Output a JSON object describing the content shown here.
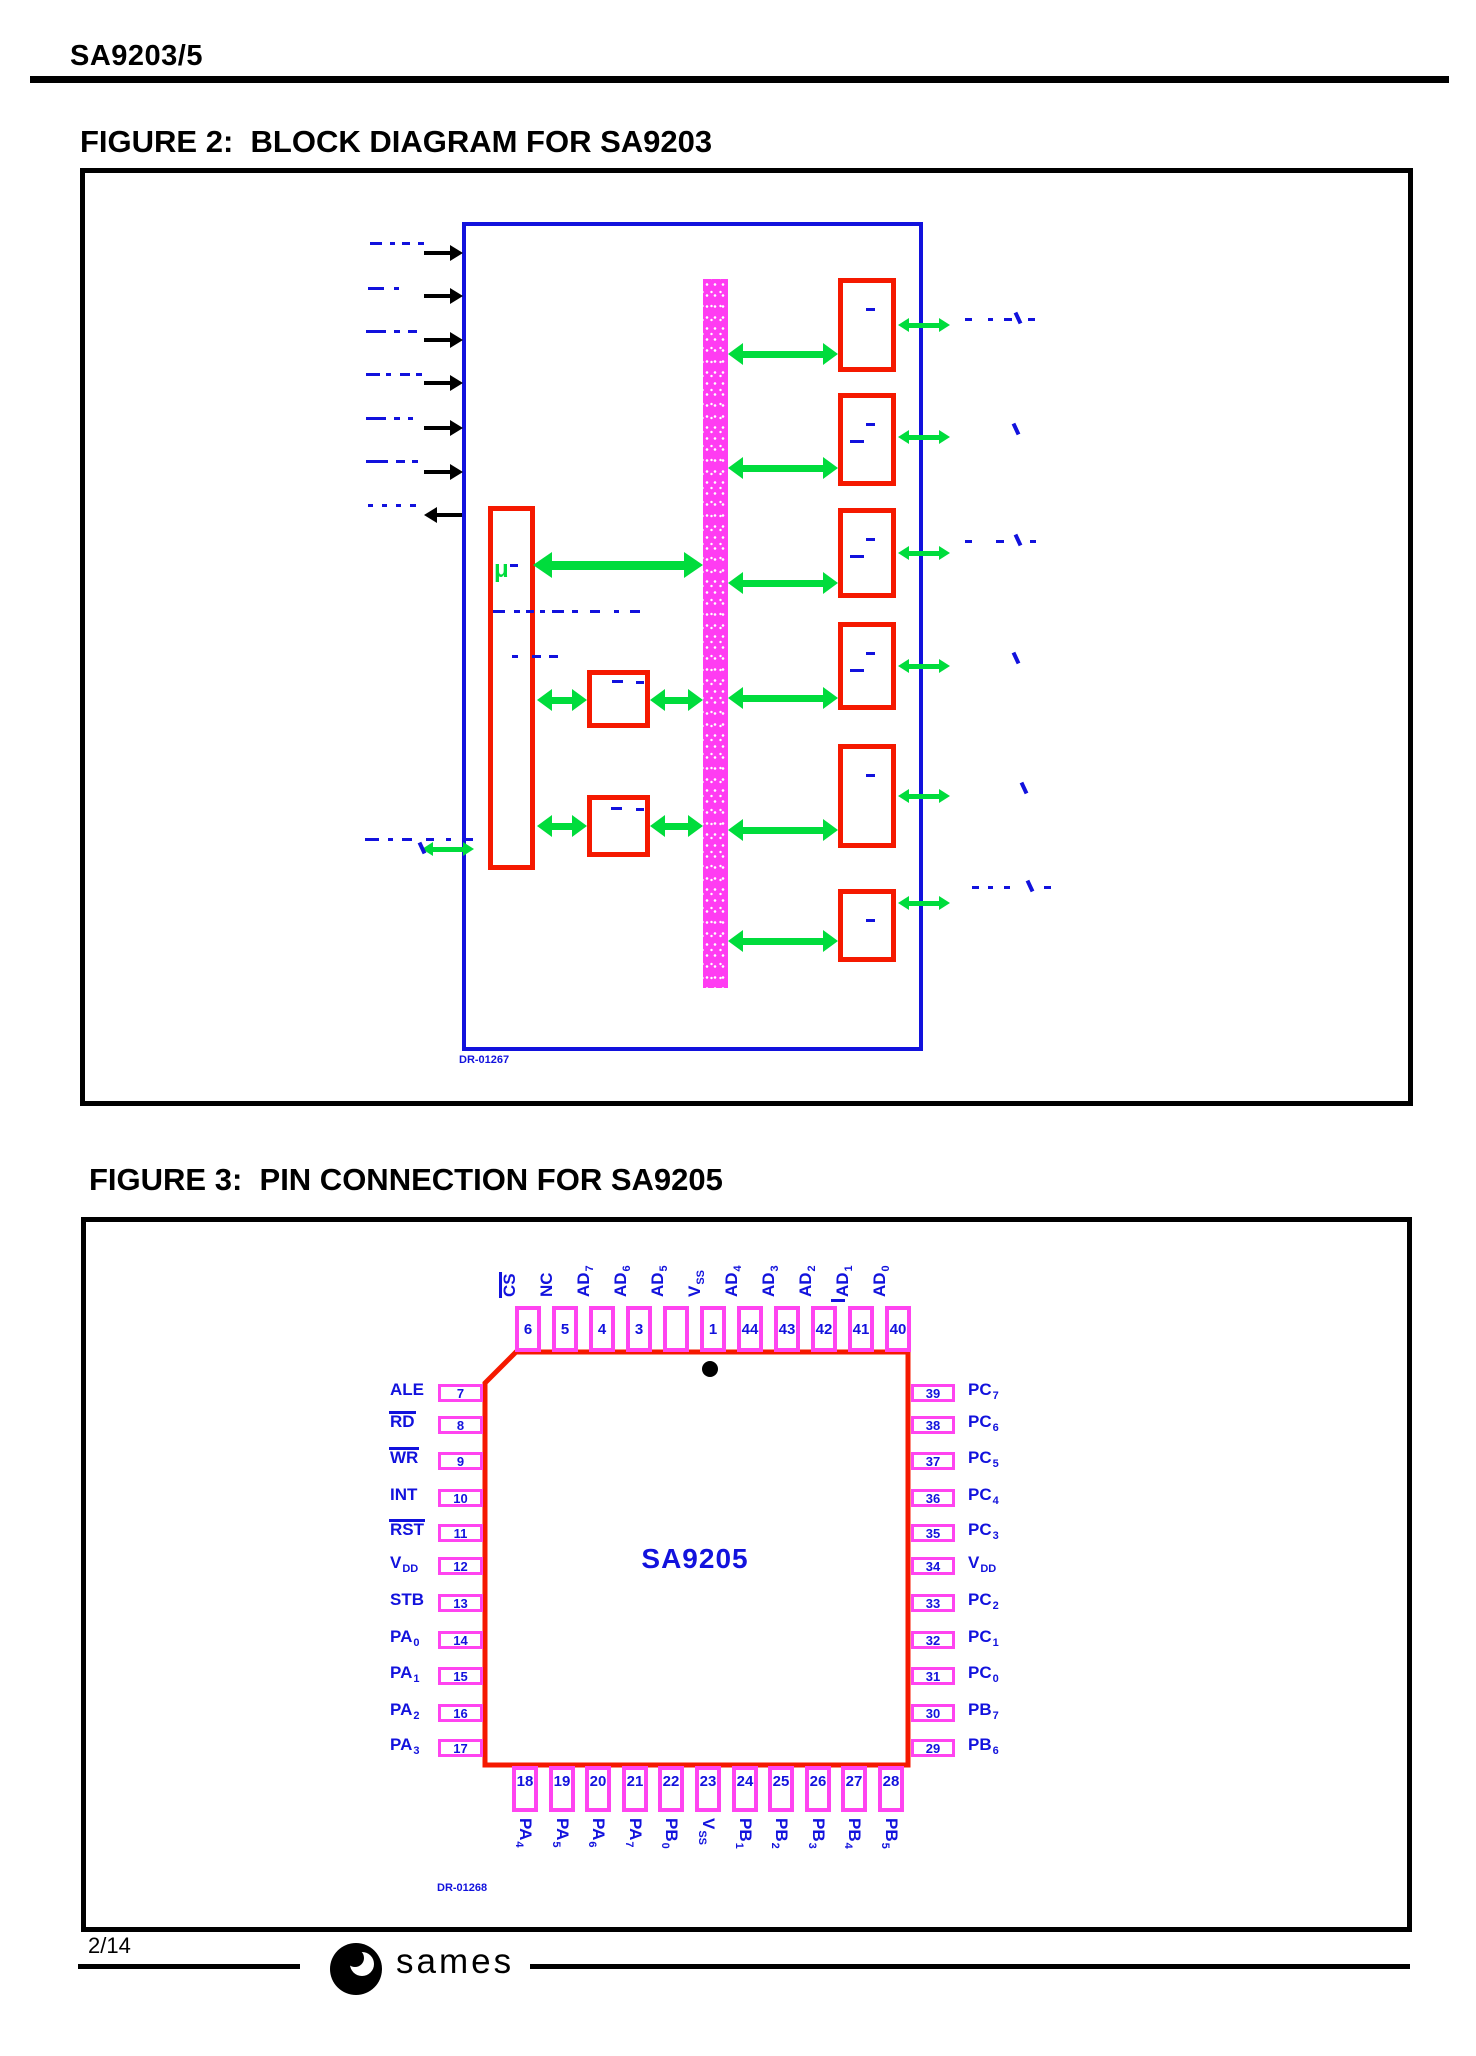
{
  "colors": {
    "line_blue": "#1212dd",
    "box_red": "#f51900",
    "pin_magenta": "#ff44f0",
    "bus_magenta": "#ff3cf2",
    "arrow_green": "#00dc3c",
    "ink_black": "#000000"
  },
  "header": {
    "part_number": "SA9203/5"
  },
  "figure2": {
    "title": "FIGURE 2:  BLOCK DIAGRAM FOR SA9203",
    "micro_label": "μ",
    "drawing_ref": "DR-01267"
  },
  "figure3": {
    "title": "FIGURE 3:  PIN CONNECTION FOR SA9205",
    "chip_name": "SA9205",
    "drawing_ref": "DR-01268",
    "top_pins": [
      {
        "num": "6",
        "base": "CS",
        "overline": true
      },
      {
        "num": "5",
        "base": "NC"
      },
      {
        "num": "4",
        "base": "AD",
        "sub": "7"
      },
      {
        "num": "3",
        "base": "AD",
        "sub": "6"
      },
      {
        "num": "",
        "base": "AD",
        "sub": "5"
      },
      {
        "num": "1",
        "base": "V",
        "sub": "SS"
      },
      {
        "num": "44",
        "base": "AD",
        "sub": "4"
      },
      {
        "num": "43",
        "base": "AD",
        "sub": "3"
      },
      {
        "num": "42",
        "base": "AD",
        "sub": "2"
      },
      {
        "num": "41",
        "base": "AD",
        "sub": "1"
      },
      {
        "num": "40",
        "base": "AD",
        "sub": "0"
      }
    ],
    "left_pins": [
      {
        "num": "7",
        "base": "ALE"
      },
      {
        "num": "8",
        "base": "RD",
        "overline": true
      },
      {
        "num": "9",
        "base": "WR",
        "overline": true
      },
      {
        "num": "10",
        "base": "INT"
      },
      {
        "num": "11",
        "base": "RST",
        "overline": true
      },
      {
        "num": "12",
        "base": "V",
        "sub": "DD"
      },
      {
        "num": "13",
        "base": "STB"
      },
      {
        "num": "14",
        "base": "PA",
        "sub": "0"
      },
      {
        "num": "15",
        "base": "PA",
        "sub": "1"
      },
      {
        "num": "16",
        "base": "PA",
        "sub": "2"
      },
      {
        "num": "17",
        "base": "PA",
        "sub": "3"
      }
    ],
    "right_pins": [
      {
        "num": "39",
        "base": "PC",
        "sub": "7"
      },
      {
        "num": "38",
        "base": "PC",
        "sub": "6"
      },
      {
        "num": "37",
        "base": "PC",
        "sub": "5"
      },
      {
        "num": "36",
        "base": "PC",
        "sub": "4"
      },
      {
        "num": "35",
        "base": "PC",
        "sub": "3"
      },
      {
        "num": "34",
        "base": "V",
        "sub": "DD"
      },
      {
        "num": "33",
        "base": "PC",
        "sub": "2"
      },
      {
        "num": "32",
        "base": "PC",
        "sub": "1"
      },
      {
        "num": "31",
        "base": "PC",
        "sub": "0"
      },
      {
        "num": "30",
        "base": "PB",
        "sub": "7"
      },
      {
        "num": "29",
        "base": "PB",
        "sub": "6"
      }
    ],
    "bottom_pins": [
      {
        "num": "18",
        "base": "PA",
        "sub": "4"
      },
      {
        "num": "19",
        "base": "PA",
        "sub": "5"
      },
      {
        "num": "20",
        "base": "PA",
        "sub": "6"
      },
      {
        "num": "21",
        "base": "PA",
        "sub": "7"
      },
      {
        "num": "22",
        "base": "PB",
        "sub": "0"
      },
      {
        "num": "23",
        "base": "V",
        "sub": "SS"
      },
      {
        "num": "24",
        "base": "PB",
        "sub": "1"
      },
      {
        "num": "25",
        "base": "PB",
        "sub": "2"
      },
      {
        "num": "26",
        "base": "PB",
        "sub": "3"
      },
      {
        "num": "27",
        "base": "PB",
        "sub": "4"
      },
      {
        "num": "28",
        "base": "PB",
        "sub": "5"
      }
    ]
  },
  "footer": {
    "page_number": "2/14",
    "brand": "sames"
  }
}
